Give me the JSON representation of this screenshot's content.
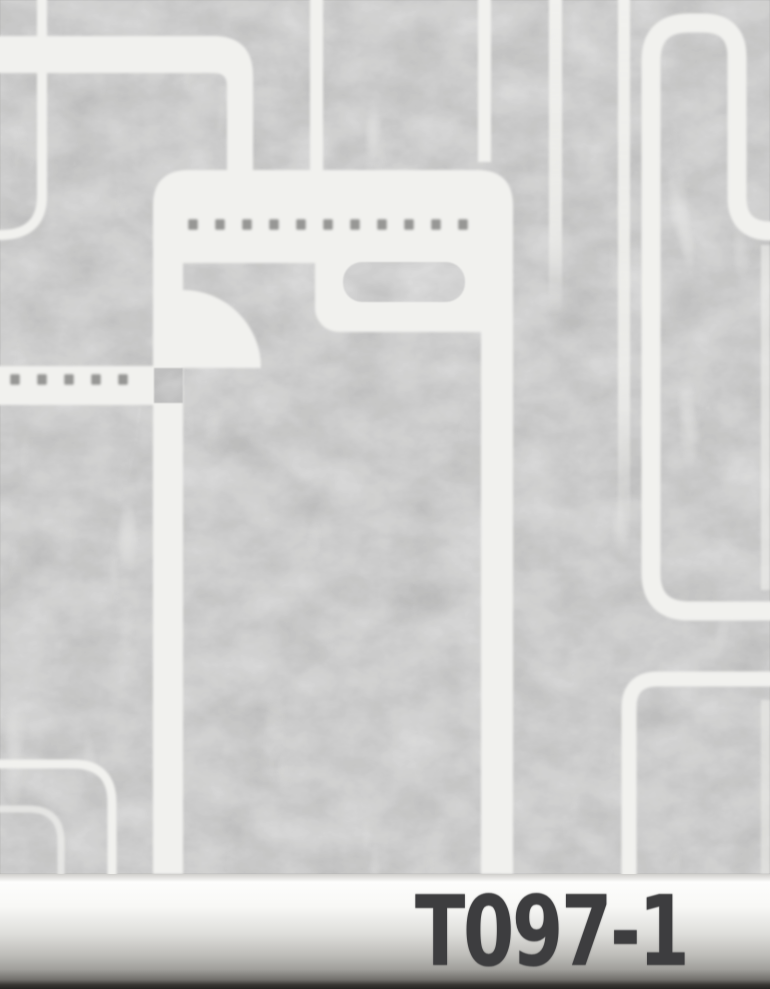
{
  "product": {
    "code": "T097-1"
  },
  "colors": {
    "texture_base": "#a3a3a1",
    "pattern": "#f1f1ee",
    "dot": "#8d8d8b",
    "junction_square": "#7d7d7b",
    "label_text": "#3d3d3f",
    "bar_top": "#fdfdfc",
    "bar_bottom": "#262421"
  }
}
